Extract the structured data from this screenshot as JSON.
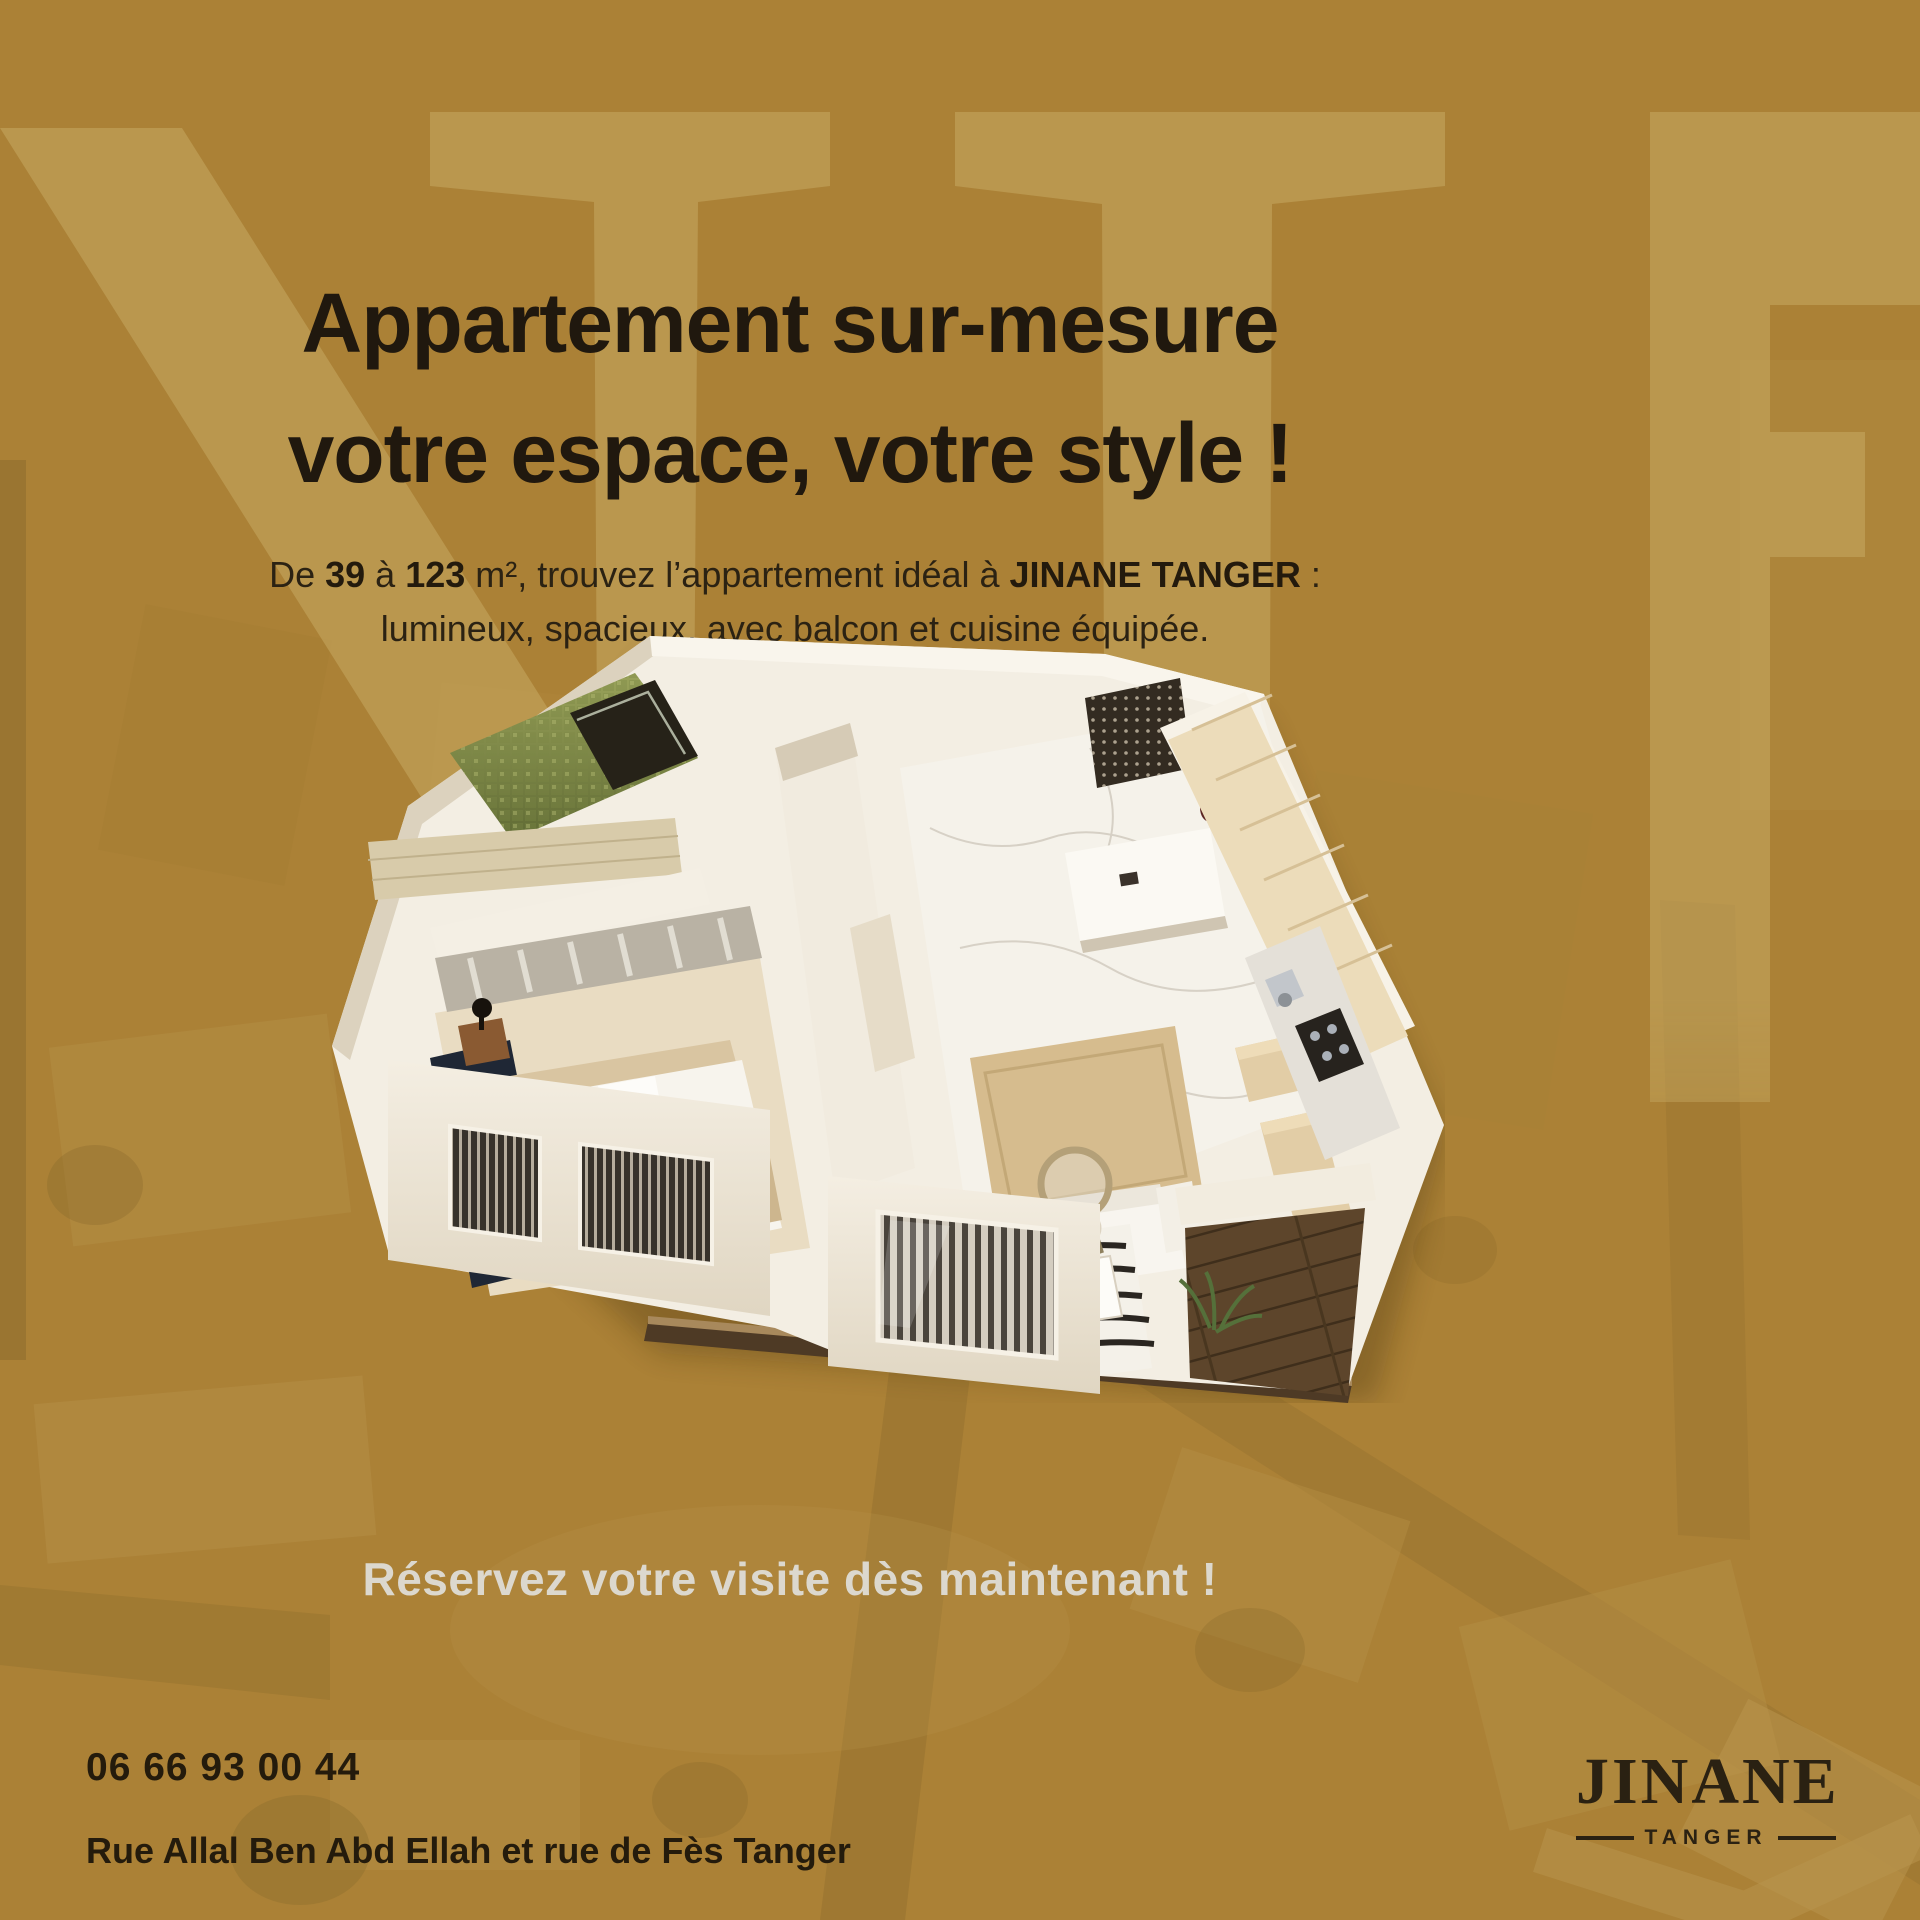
{
  "headline": {
    "line1": "Appartement sur-mesure",
    "line2": "votre espace, votre style !"
  },
  "body": {
    "prefix": "De ",
    "bold_min": "39",
    "mid1": " à ",
    "bold_max": "123",
    "mid2": " m², trouvez l’appartement idéal à ",
    "bold_brand": "JINANE TANGER",
    "suffix": " :",
    "line2": "lumineux, spacieux, avec balcon et cuisine équipée."
  },
  "cta": "Réservez votre visite dès maintenant !",
  "contact": {
    "phone": "06 66 93 00 44",
    "address": "Rue Allal Ben Abd Ellah et rue de Fès Tanger"
  },
  "logo": {
    "name": "JINANE",
    "city": "TANGER"
  },
  "colors": {
    "background": "#ab8136",
    "watermark": "#c7a963",
    "headline_text": "#20180e",
    "cta_text": "#dcd8ce",
    "contact_text": "#241b0c",
    "logo_text": "#2a2112"
  }
}
